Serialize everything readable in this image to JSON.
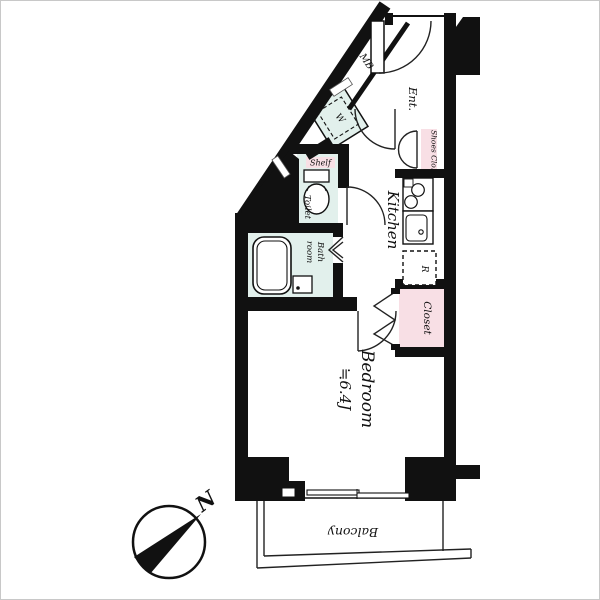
{
  "page": {
    "type": "apartment-floor-plan"
  },
  "colors": {
    "wall": "#111111",
    "wet_area_fill": "#e2f0ec",
    "closet_fill": "#f8dfe5",
    "line": "#222222",
    "background": "#ffffff"
  },
  "rooms": {
    "meter_box": {
      "label": "MB"
    },
    "entrance": {
      "label": "Ent."
    },
    "washer": {
      "label": "W"
    },
    "shoes_closet": {
      "label": "Shoes Clo."
    },
    "kitchen": {
      "label": "Kitchen"
    },
    "shelf": {
      "label": "Shelf"
    },
    "toilet": {
      "label": "Toilet"
    },
    "bathroom": {
      "line1": "Bath",
      "line2": "room"
    },
    "refrigerator": {
      "label": "R"
    },
    "closet": {
      "label": "Closet"
    },
    "bedroom": {
      "line1": "Bedroom",
      "line2": "≒6.4J"
    },
    "balcony": {
      "label": "Balcony"
    }
  },
  "compass": {
    "north_label": "N"
  }
}
